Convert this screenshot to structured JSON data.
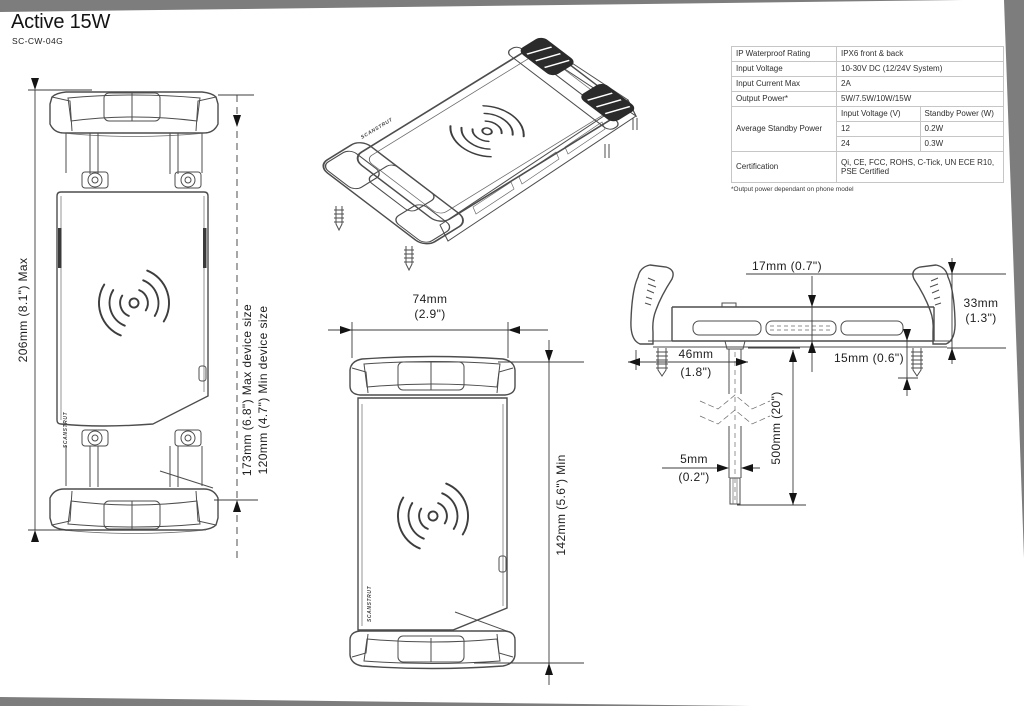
{
  "page": {
    "title": "Active 15W",
    "subtitle": "SC-CW-04G",
    "brand": "SCANSTRUT"
  },
  "spec_table": {
    "rows": [
      {
        "label": "IP Waterproof Rating",
        "value": "IPX6 front & back"
      },
      {
        "label": "Input Voltage",
        "value": "10-30V DC (12/24V System)"
      },
      {
        "label": "Input Current Max",
        "value": "2A"
      },
      {
        "label": "Output Power*",
        "value": "5W/7.5W/10W/15W"
      }
    ],
    "standby": {
      "label": "Average Standby Power",
      "col1": "Input Voltage (V)",
      "col2": "Standby Power (W)",
      "rows": [
        {
          "voltage": "12",
          "power": "0.2W"
        },
        {
          "voltage": "24",
          "power": "0.3W"
        }
      ]
    },
    "certification": {
      "label": "Certification",
      "value": "Qi, CE, FCC, ROHS, C-Tick, UN ECE R10, PSE Certified"
    },
    "footnote": "*Output power dependant on phone model"
  },
  "dimensions": {
    "overall_length": "206mm (8.1\") Max",
    "max_device": "173mm (6.8\") Max device size",
    "min_device": "120mm (4.7\") Min device size",
    "width_mm": "74mm",
    "width_in": "(2.9\")",
    "min_length": "142mm (5.6\") Min",
    "lip_depth": "17mm (0.7\")",
    "height_mm": "33mm",
    "height_in": "(1.3\")",
    "offset_mm": "46mm",
    "offset_in": "(1.8\")",
    "screw_len": "15mm (0.6\")",
    "cable_d_mm": "5mm",
    "cable_d_in": "(0.2\")",
    "cable_len": "500mm (20\")"
  }
}
